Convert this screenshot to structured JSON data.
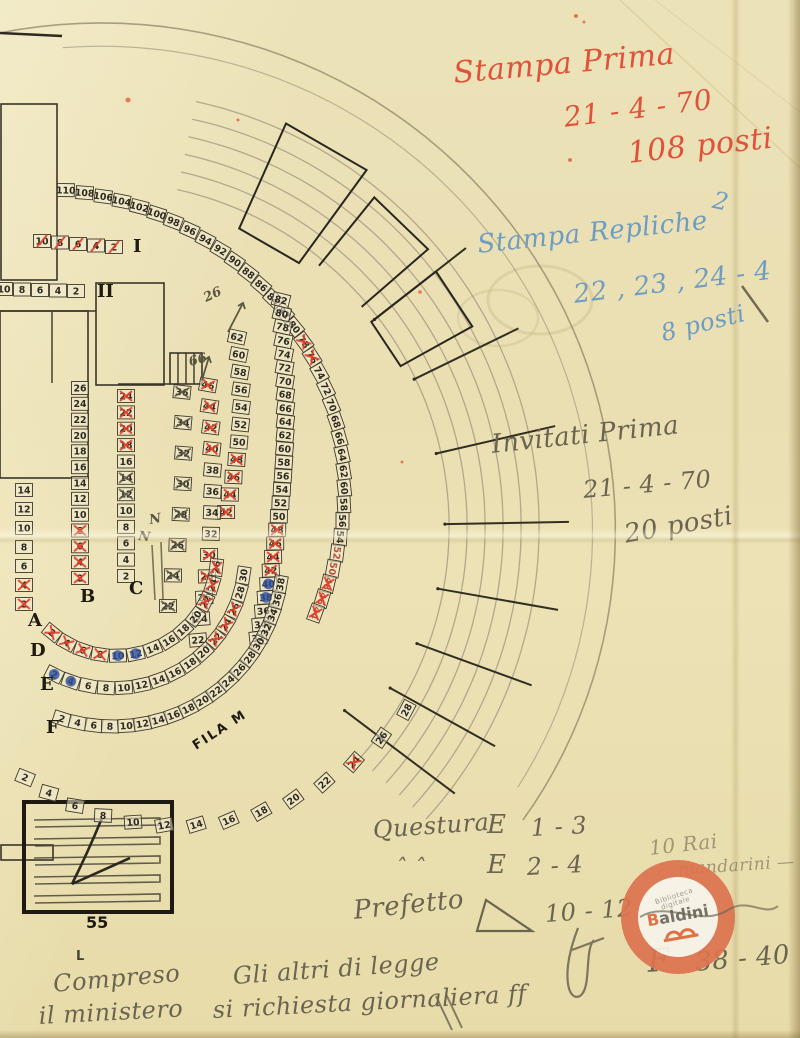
{
  "colors": {
    "paper": "#ece2b6",
    "ink": "#2e2a20",
    "red_ink": "#e2402b",
    "blue_ink": "#2d4f9e",
    "pencil": "#5c5742",
    "stamp_orange": "#dd7450"
  },
  "annotations": {
    "notes": [
      {
        "id": "stampa-prima-1",
        "text": "Stampa Prima",
        "x": 452,
        "y": 56,
        "rot": -5,
        "fs": 30,
        "cls": "red"
      },
      {
        "id": "stampa-prima-2",
        "text": "21 - 4 - 70",
        "x": 562,
        "y": 101,
        "rot": -7,
        "fs": 28,
        "cls": "red"
      },
      {
        "id": "stampa-prima-3",
        "text": "108 posti",
        "x": 626,
        "y": 136,
        "rot": -6,
        "fs": 30,
        "cls": "red"
      },
      {
        "id": "blue-mark",
        "text": "2",
        "x": 716,
        "y": 186,
        "rot": 12,
        "fs": 24,
        "cls": "blue"
      },
      {
        "id": "stampa-repliche-1",
        "text": "Stampa Repliche",
        "x": 476,
        "y": 230,
        "rot": -6,
        "fs": 26,
        "cls": "blue"
      },
      {
        "id": "stampa-repliche-2",
        "text": "22 , 23 , 24 - 4",
        "x": 572,
        "y": 280,
        "rot": -7,
        "fs": 26,
        "cls": "blue"
      },
      {
        "id": "stampa-repliche-3",
        "text": "8 posti",
        "x": 658,
        "y": 320,
        "rot": -14,
        "fs": 24,
        "cls": "blue"
      },
      {
        "id": "invitati-prima-1",
        "text": "Invitati Prima",
        "x": 490,
        "y": 430,
        "rot": -6,
        "fs": 26,
        "cls": "pencil"
      },
      {
        "id": "invitati-prima-2",
        "text": "21 - 4 - 70",
        "x": 582,
        "y": 476,
        "rot": -5,
        "fs": 24,
        "cls": "pencil"
      },
      {
        "id": "invitati-prima-3",
        "text": "20 posti",
        "x": 622,
        "y": 520,
        "rot": -10,
        "fs": 26,
        "cls": "pencil"
      },
      {
        "id": "questura-label",
        "text": "Questura",
        "x": 372,
        "y": 816,
        "rot": -4,
        "fs": 24,
        "cls": "pencil"
      },
      {
        "id": "questura-row1-letter",
        "text": "E",
        "x": 487,
        "y": 810,
        "rot": 0,
        "fs": 26,
        "cls": "pencil"
      },
      {
        "id": "questura-row1-range",
        "text": "1 - 3",
        "x": 530,
        "y": 814,
        "rot": -3,
        "fs": 24,
        "cls": "pencil"
      },
      {
        "id": "questura-ditto",
        "text": "ˆ   ˆ",
        "x": 395,
        "y": 856,
        "rot": 0,
        "fs": 22,
        "cls": "pencil"
      },
      {
        "id": "questura-row2-letter",
        "text": "E",
        "x": 487,
        "y": 850,
        "rot": 0,
        "fs": 26,
        "cls": "pencil"
      },
      {
        "id": "questura-row2-range",
        "text": "2 - 4",
        "x": 526,
        "y": 853,
        "rot": -3,
        "fs": 24,
        "cls": "pencil"
      },
      {
        "id": "prefetto-label",
        "text": "Prefetto",
        "x": 352,
        "y": 896,
        "rot": -6,
        "fs": 26,
        "cls": "pencil"
      },
      {
        "id": "prefetto-range",
        "text": "10 - 12",
        "x": 544,
        "y": 900,
        "rot": -4,
        "fs": 24,
        "cls": "pencil"
      },
      {
        "id": "rai-note-1",
        "text": "10 Rai",
        "x": 648,
        "y": 836,
        "rot": -6,
        "fs": 20,
        "cls": "pencil-faint"
      },
      {
        "id": "rai-note-2",
        "text": "mandarini —",
        "x": 678,
        "y": 860,
        "rot": -4,
        "fs": 17,
        "cls": "pencil-faint"
      },
      {
        "id": "f-note-letter",
        "text": "F",
        "x": 646,
        "y": 942,
        "rot": -4,
        "fs": 32,
        "cls": "pencil"
      },
      {
        "id": "f-note-range",
        "text": "38 - 40",
        "x": 694,
        "y": 948,
        "rot": -5,
        "fs": 26,
        "cls": "pencil"
      },
      {
        "id": "compreso-1",
        "text": "Compreso",
        "x": 52,
        "y": 970,
        "rot": -5,
        "fs": 24,
        "cls": "pencil"
      },
      {
        "id": "compreso-2",
        "text": "il ministero",
        "x": 38,
        "y": 1002,
        "rot": -3,
        "fs": 24,
        "cls": "pencil"
      },
      {
        "id": "gli-altri-1",
        "text": "Gli altri di legge",
        "x": 232,
        "y": 962,
        "rot": -4,
        "fs": 24,
        "cls": "pencil"
      },
      {
        "id": "gli-altri-2",
        "text": "si richiesta giornaliera  ff",
        "x": 212,
        "y": 996,
        "rot": -3,
        "fs": 24,
        "cls": "pencil"
      }
    ]
  },
  "stamp": {
    "org_line1": "Biblioteca",
    "org_line2": "digitale",
    "name_accent": "B",
    "name_rest": "aldini"
  },
  "seatmap": {
    "runs": [
      {
        "id": "arc-outer",
        "type": "spiral",
        "cx": 60,
        "cy": 520,
        "r0": 330,
        "a0": 1,
        "r1": 272,
        "a1": 110,
        "nums": [
          "110",
          "108",
          "106",
          "104",
          "102",
          "100",
          "98",
          "96",
          "94",
          "92",
          "90",
          "88",
          "86",
          "84",
          "82",
          "80",
          "78",
          "76",
          "74",
          "72",
          "70",
          "68",
          "66",
          "64",
          "62",
          "60",
          "58",
          "56",
          "54",
          "52",
          "50",
          "48",
          "46",
          "44"
        ],
        "red": [
          16,
          17,
          31,
          32,
          33
        ],
        "redink": [
          29,
          30,
          31,
          32,
          33
        ],
        "blue": [],
        "pencilx": []
      },
      {
        "id": "arc-mid",
        "type": "bend",
        "x0": 281,
        "x1": 258,
        "bend": 14,
        "y0": 300,
        "y1": 638,
        "rot0": 14,
        "rot1": -6,
        "nums": [
          "82",
          "80",
          "78",
          "76",
          "74",
          "72",
          "70",
          "68",
          "66",
          "64",
          "62",
          "60",
          "58",
          "56",
          "54",
          "52",
          "50",
          "48",
          "46",
          "44",
          "42",
          "40",
          "38",
          "36",
          "34",
          "32"
        ],
        "red": [
          17,
          18,
          19,
          20
        ],
        "blue": [
          21,
          22
        ],
        "redink": [],
        "pencilx": []
      },
      {
        "id": "arc-62",
        "type": "bend",
        "x0": 237,
        "x1": 226,
        "bend": 9,
        "y0": 337,
        "y1": 512,
        "rot0": 12,
        "rot1": 0,
        "nums": [
          "62",
          "60",
          "58",
          "56",
          "54",
          "52",
          "50",
          "48",
          "46",
          "44",
          "42"
        ],
        "red": [
          7,
          8,
          9,
          10
        ],
        "blue": [],
        "redink": [],
        "pencilx": []
      },
      {
        "id": "arc-46",
        "type": "bend",
        "x0": 208,
        "x1": 198,
        "bend": 9,
        "y0": 385,
        "y1": 640,
        "rot0": 10,
        "rot1": -5,
        "nums": [
          "46",
          "44",
          "42",
          "40",
          "38",
          "36",
          "34",
          "32",
          "30",
          "28",
          "26",
          "24",
          "22"
        ],
        "red": [
          0,
          1,
          2,
          3,
          8,
          9
        ],
        "blue": [],
        "redink": [],
        "pencilx": []
      },
      {
        "id": "col-pencil",
        "type": "bend",
        "x0": 182,
        "x1": 168,
        "bend": 7,
        "y0": 392,
        "y1": 606,
        "rot0": 6,
        "rot1": 0,
        "nums": [
          "36",
          "34",
          "32",
          "30",
          "28",
          "26",
          "24",
          "22"
        ],
        "red": [],
        "blue": [],
        "redink": [],
        "pencilx": [
          0,
          1,
          2,
          3,
          4,
          5,
          6,
          7
        ]
      },
      {
        "id": "col-B",
        "type": "col",
        "x": 80,
        "y0": 388,
        "y1": 578,
        "nums": [
          "26",
          "24",
          "22",
          "20",
          "18",
          "16",
          "14",
          "12",
          "10",
          "8",
          "6",
          "4",
          "2"
        ],
        "red": [
          9,
          10,
          11,
          12
        ],
        "blue": [],
        "redink": [],
        "pencilx": [],
        "label": "B",
        "labelX": 80,
        "labelY": 602
      },
      {
        "id": "col-C",
        "type": "col",
        "x": 126,
        "y0": 396,
        "y1": 576,
        "nums": [
          "24",
          "22",
          "20",
          "18",
          "16",
          "14",
          "12",
          "10",
          "8",
          "6",
          "4",
          "2"
        ],
        "red": [
          0,
          1,
          2,
          3
        ],
        "blue": [],
        "redink": [],
        "pencilx": [
          5,
          6
        ],
        "label": "C",
        "labelX": 129,
        "labelY": 594
      },
      {
        "id": "col-A",
        "type": "col",
        "x": 24,
        "y0": 490,
        "y1": 604,
        "nums": [
          "14",
          "12",
          "10",
          "8",
          "6",
          "4",
          "2"
        ],
        "red": [
          5,
          6
        ],
        "blue": [],
        "redink": [],
        "pencilx": [],
        "label": "A",
        "labelX": 28,
        "labelY": 626
      },
      {
        "id": "row-I",
        "type": "row",
        "y": 241,
        "x0": 42,
        "x1": 114,
        "tilt": 6,
        "nums": [
          "10",
          "8",
          "6",
          "4",
          "2"
        ],
        "red": [],
        "blue": [],
        "redink": [],
        "pencilx": [],
        "redslash": [
          0,
          1,
          2,
          3,
          4
        ],
        "label": "I",
        "labelX": 133,
        "labelY": 252
      },
      {
        "id": "row-II",
        "type": "row",
        "y": 289,
        "x0": 4,
        "x1": 76,
        "tilt": 2,
        "nums": [
          "10",
          "8",
          "6",
          "4",
          "2"
        ],
        "red": [],
        "blue": [],
        "redink": [],
        "pencilx": [],
        "label": "II",
        "labelX": 97,
        "labelY": 297
      },
      {
        "id": "row-D",
        "type": "spiral",
        "cx": 115,
        "cy": 555,
        "r0": 100,
        "a0": 219,
        "r1": 102,
        "a1": 97,
        "upright": true,
        "nums": [
          "2",
          "4",
          "6",
          "8",
          "10",
          "12",
          "14",
          "16",
          "18",
          "20",
          "22",
          "24",
          "26"
        ],
        "red": [
          0,
          1,
          2,
          3,
          10,
          11,
          12
        ],
        "blue": [
          4,
          5
        ],
        "redink": [],
        "pencilx": [],
        "label": "D",
        "labelX": 30,
        "labelY": 656
      },
      {
        "id": "row-E",
        "type": "spiral",
        "cx": 115,
        "cy": 555,
        "r0": 134,
        "a0": 207,
        "r1": 130,
        "a1": 99,
        "upright": true,
        "nums": [
          "2",
          "4",
          "6",
          "8",
          "10",
          "12",
          "14",
          "16",
          "18",
          "20",
          "22",
          "24",
          "26",
          "28",
          "30"
        ],
        "red": [
          10,
          11,
          12
        ],
        "blue": [
          0,
          1
        ],
        "redink": [],
        "pencilx": [],
        "label": "E",
        "labelX": 40,
        "labelY": 690
      },
      {
        "id": "row-F",
        "type": "spiral",
        "cx": 115,
        "cy": 555,
        "r0": 172,
        "a0": 198,
        "r1": 168,
        "a1": 100,
        "upright": true,
        "nums": [
          "2",
          "4",
          "6",
          "8",
          "10",
          "12",
          "14",
          "16",
          "18",
          "20",
          "22",
          "24",
          "26",
          "28",
          "30",
          "32",
          "34",
          "36",
          "38"
        ],
        "red": [],
        "blue": [],
        "redink": [],
        "pencilx": [],
        "label": "F",
        "labelX": 46,
        "labelY": 733
      },
      {
        "id": "row-M",
        "type": "spiral",
        "cx": 115,
        "cy": 555,
        "r0": 240,
        "a0": 202,
        "r1": 330,
        "a1": 118,
        "upright": true,
        "nums": [
          "2",
          "4",
          "6",
          "8",
          "10",
          "12",
          "14",
          "16",
          "18",
          "20",
          "22",
          "24",
          "26",
          "28"
        ],
        "red": [
          11
        ],
        "blue": [],
        "redink": [],
        "pencilx": []
      }
    ],
    "fila_label": {
      "text": "FILA M",
      "x": 196,
      "y": 750,
      "rot": -33
    },
    "pencil_markers": [
      {
        "text": "26",
        "x": 206,
        "y": 302,
        "rot": -25
      },
      {
        "text": "66",
        "x": 190,
        "y": 366,
        "rot": -15
      },
      {
        "text": "N",
        "x": 150,
        "y": 524,
        "rot": -10
      },
      {
        "text": "N",
        "x": 138,
        "y": 540,
        "rot": 6
      }
    ],
    "stage": {
      "label": "55",
      "corner_mark": "L"
    }
  }
}
